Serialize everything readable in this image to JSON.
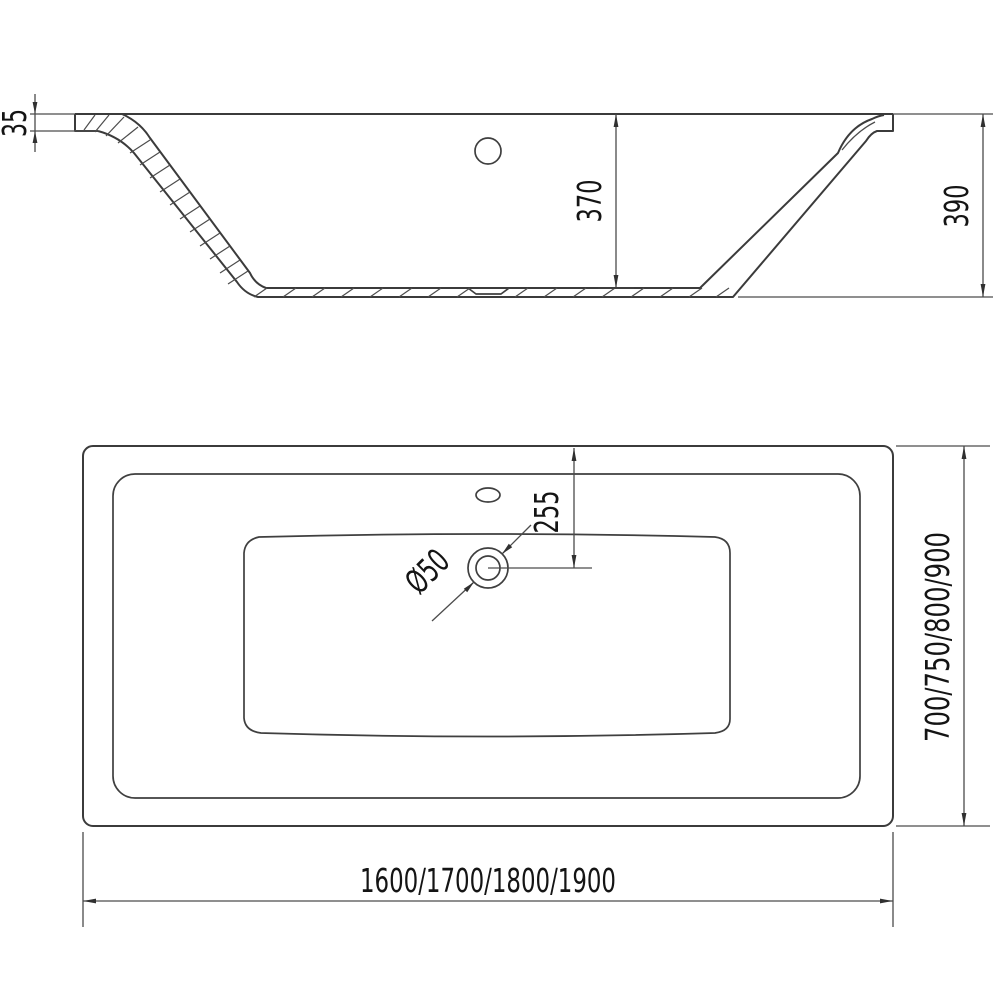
{
  "drawing": {
    "type": "bathtub technical dimension drawing",
    "background_color": "#ffffff",
    "line_color": "#3b3b3b",
    "text_color": "#141414",
    "section_view": {
      "dims": {
        "rim_thickness": "35",
        "inner_depth": "370",
        "overall_height": "390"
      }
    },
    "plan_view": {
      "dims": {
        "drain_offset": "255",
        "drain_diameter": "Ø50",
        "length_options": "1600/1700/1800/1900",
        "width_options": "700/750/800/900"
      }
    }
  }
}
